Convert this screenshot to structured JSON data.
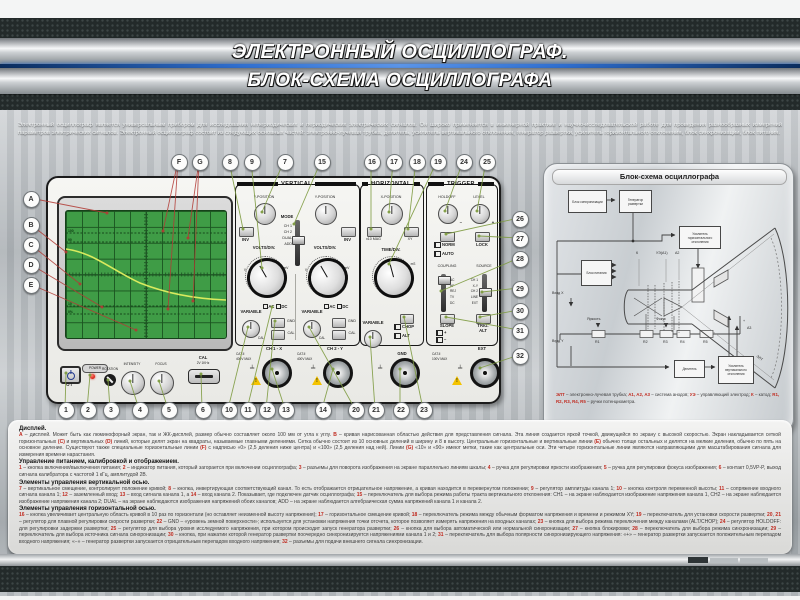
{
  "header": {
    "title_line1": "ЭЛЕКТРОННЫЙ ОСЦИЛЛОГРАФ.",
    "title_line2": "БЛОК-СХЕМА ОСЦИЛЛОГРАФА"
  },
  "intro": "Электронный осциллограф является универсальным прибором для исследования непериодических и периодических электрических сигналов. Он широко применяется в инженерной практике и научно-исследовательской работе для проведения разнообразных измерений параметров электрических сигналов. Электронный осциллограф состоит из следующих основных частей: электронно-лучевая трубка, делитель, усилитель вертикального отклонения, генератор развертки, усилитель горизонтального отклонения, блок синхронизации, блок питания.",
  "scope": {
    "screen": {
      "pct100": "100",
      "pct90": "90",
      "pct10": "10",
      "pct0": "0%"
    },
    "power": {
      "power": "POWER",
      "marks": "O   I"
    },
    "bottom": {
      "rotation": "ROTATION",
      "intensity": "INTENSITY",
      "focus": "FOCUS",
      "cal": "CAL",
      "cal_sub": "2V 1KHz"
    },
    "vertical": {
      "title": "VERTICAL",
      "y_position": "Y-POSITION",
      "inv": "INV",
      "mode": "MODE",
      "mode_options": [
        "CH 1",
        "CH 2",
        "DUAL",
        "ADD"
      ],
      "volts_div": "VOLTS/DIV.",
      "unit_v": "V",
      "unit_mv": "mV",
      "variable": "VARIABLE",
      "cal": "CAL",
      "ac": "AC",
      "dc": "DC",
      "gnd": "GND",
      "cat": "CAT.II",
      "max": "400V MAX",
      "ch1_input": "CH 1 - X",
      "ch2_input": "CH 2 - Y"
    },
    "horizontal": {
      "title": "HORIZONTAL",
      "x_position": "X-POSITION",
      "mag": "x10 MAG",
      "xy": "XY",
      "time_div": "TIME/DIV.",
      "unit_ms": "mS",
      "variable": "VARIABLE",
      "chop": "CHOP",
      "alt": "ALT",
      "gnd": "GND"
    },
    "trigger": {
      "title": "TRIGGER",
      "holdoff": "HOLDOFF",
      "level": "LEVEL",
      "minus": "−",
      "plus": "+",
      "norm": "NORM",
      "auto": "AUTO",
      "lock": "LOCK",
      "coupling": "COUPLING",
      "coupling_options": [
        "AC",
        "HF",
        "REJ",
        "TV",
        "DC"
      ],
      "source": "SOURCE",
      "source_options": [
        "CH 1",
        "X-Y",
        "CH 2",
        "LINE",
        "EXT"
      ],
      "slope": "SLOPE",
      "slope_plus": "+",
      "slope_minus": "−",
      "trig": "TRIG.",
      "trig_alt": "ALT",
      "cat": "CAT.II",
      "max": "100V MAX",
      "ext": "EXT"
    }
  },
  "callouts": {
    "letters": [
      "A",
      "B",
      "C",
      "D",
      "E",
      "F",
      "G"
    ],
    "top": [
      "8",
      "9",
      "7",
      "15",
      "16",
      "17",
      "18",
      "19",
      "24",
      "25"
    ],
    "bottom": [
      "1",
      "2",
      "3",
      "4",
      "5",
      "6",
      "10",
      "11",
      "12",
      "13",
      "14",
      "20",
      "21",
      "22",
      "23"
    ],
    "right": [
      "26",
      "27",
      "28",
      "29",
      "30",
      "31",
      "32"
    ]
  },
  "diagram": {
    "title": "Блок-схема осциллографа",
    "blocks": {
      "sync": "Блок синхронизации",
      "sweep": "Генератор развертки",
      "hamp": "Усилитель горизонтального отклонения",
      "power": "Блок питания",
      "divider": "Делитель",
      "vamp": "Усилитель вертикального отклонения"
    },
    "labels": {
      "in_x": "Вход X",
      "in_y": "Вход Y",
      "bright": "Яркость",
      "focus": "Фокус",
      "r1": "R1",
      "r2": "R2",
      "r3": "R3",
      "r4": "R4",
      "r5": "R5",
      "k": "К",
      "ue": "УЭ(А1)",
      "a2": "А2",
      "a3": "А3",
      "elt": "ЭЛТ",
      "minus": "−",
      "plus": "+"
    },
    "legend": "[[ЭЛТ]] – электронно-лучевая трубка; [[А1, А2, А3]] – система анодов; [[УЭ]] – управляющий электрод; [[К]] – катод; [[R1, R2, R3, R4, R5]] – ручки потенциометра."
  },
  "notes": {
    "sections": [
      {
        "title": "Дисплей.",
        "body": "[[А]] – дисплей. Может быть как люминофорный экран, так и ЖК-дисплей, размер обычно составляет около 100 мм от угла к углу. [[В]] – кривая нарисованная областью действия для представления сигнала. Эта линия создается яркой точкой, движущейся по экрану с высокой скоростью. Экран накладывается сеткой горизонтальных [[(С)]] и вертикальных [[(D)]] линий, которые делят экран на квадраты, называемые главными делениями. Сетка обычно состоит из 10 основных делений в ширину и 8 в высоту. Центральные горизонтальные и вертикальные линии [[(Е)]] обычно толще остальных и делятся на мелкие деления, обычно по пять на основное деление. Существуют также специальные горизонтальные линии [[(F)]] с надписью «0» (2,5 деления ниже центра) и «100» (2,5 деления над ней). Линии [[(G)]] «10» и «90» имеют метки, такие как центральные оси. Эти четыре горизонтальные линии являются направляющими для масштабирования сигнала для измерения времени нарастания."
      },
      {
        "title": "Управление питанием, калибровкой и отображением.",
        "body": "[[1]] – кнопка включения/выключения питания; [[2]] – индикатор питания, который загорается при включении осциллографа; [[3]] – разъемы для поворота изображения на экране параллельно линиям шкалы; [[4]] – ручка для регулировки яркости изображения; [[5]] – ручка для регулировки фокуса изображения; [[6]] – контакт 0,5VP-P, выход сигнала калибратора с частотой 1 кГц, амплитудой 2В."
      },
      {
        "title": "Элементы управления вертикальной осью.",
        "body": "[[7]] – вертикальное смещение, контролирует положение кривой; [[8]] – кнопка, инвертирующая соответствующий канал. То есть отображается отрицательное напряжение, а кривая находится в перевернутом положении; [[9]] – регулятор амплитуды канала 1; [[10]] – кнопка контроля переменной высоты; [[11]] – сопряжение входного сигнала канала 1; [[12]] – заземленный вход; [[13]] – вход сигнала канала 1, а [[14]] – вход канала 2. Показывает, где подключен датчик осциллографа; [[15]] – переключатель для выбора режима работы тракта вертикального отклонения: СН1 – на экране наблюдается изображение напряжения канала 1, СН2 – на экране наблюдается изображение напряжения канала 2; DUAL – на экране наблюдаются изображения напряжений обоих каналов; ADD – на экране наблюдается алгебраическая сумма напряжений канала 1 и канала 2."
      },
      {
        "title": "Элементы управления горизонтальной осью.",
        "body": "[[16]] – кнопка увеличивает центральную область кривой в 10 раз по горизонтали (но оставляет неизменной высоту напряжения); [[17]] – горизонтальное смещение кривой; [[18]] – переключатель режима между обычным форматом напряжения и времени и режимом XY; [[19]] – переключатель для установки скорости развертки; [[20]], [[21]] – регулятор для плавной регулировки скорости развертки; [[22]] – GND – «уровень земной поверхности»; используется для установки напряжения точки отсчета, которое позволяет измерять напряжения на входных каналах; [[23]] – кнопка для выбора режима переключения между каналами (ALT/CHOP); [[24]] – регулятор HOLDOFF: для регулировки задержки развертки; [[25]] – регулятор для выбора уровня исследуемого напряжения, при котором происходит запуск генератора развертки; [[26]] – кнопка для выбора автоматической или нормальной синхронизации; [[27]] – кнопка блокировки; [[28]] – переключатель для выбора режима синхронизации; [[29]] – переключатель для выбора источника сигнала синхронизации; [[30]] – кнопка, при нажатии которой генератор развертки поочередно синхронизируется напряжениями канала 1 и 2; [[31]] – переключатель для выбора полярности синхронизирующего напряжения: «+» – генератор развертки запускается положительным перепадом входного напряжения; «−» – генератор развертки запускается отрицательным перепадом входного напряжения; [[32]] – разъемы для подачи внешнего сигнала синхронизации."
      }
    ]
  }
}
